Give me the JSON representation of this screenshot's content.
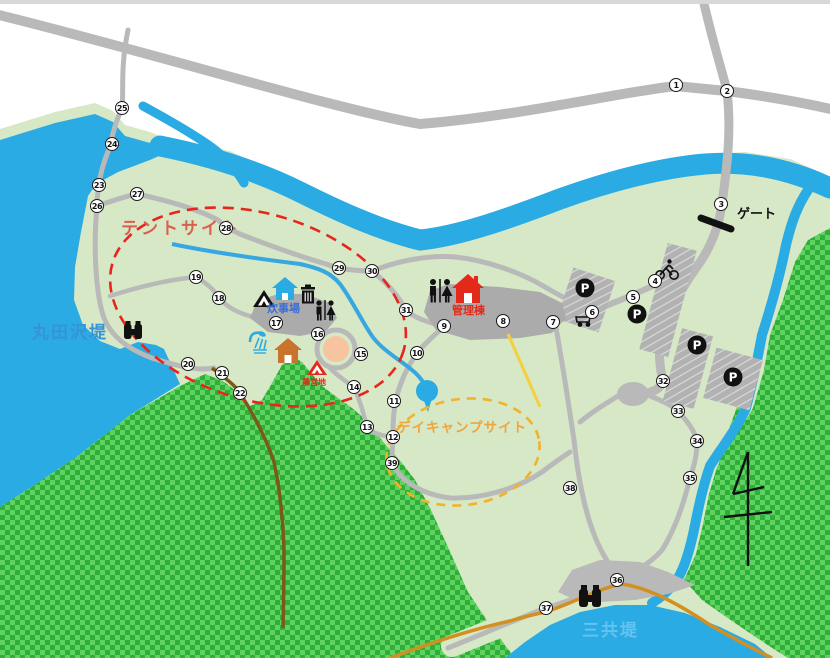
{
  "map": {
    "area_labels": {
      "lake_left": "丸田沢堤",
      "pond_bottom": "三共堤",
      "tent_site": "テントサイト",
      "day_camp_site": "デイキャンプサイト",
      "cooking_area": "炊事場",
      "admin_building": "管理棟",
      "gate": "ゲート",
      "camp_ground": "幕営地"
    },
    "icons": {
      "parking_letter": "P"
    },
    "colors": {
      "water": "#2aabe3",
      "park_green": "#d6e8c5",
      "forest_light": "#5fd35f",
      "forest_dark": "#2fae3a",
      "road_gray": "#b9b9b9",
      "building_gray": "#ababab",
      "tent_site_red": "#e8251d",
      "day_camp_yellow": "#f3b229",
      "trail_brown": "#7a5a17",
      "trail_orange": "#d29022",
      "fire_circle_pink": "#f6c5a0"
    },
    "markers": [
      {
        "n": "1",
        "x": 676,
        "y": 85
      },
      {
        "n": "2",
        "x": 727,
        "y": 91
      },
      {
        "n": "3",
        "x": 721,
        "y": 204
      },
      {
        "n": "4",
        "x": 655,
        "y": 281
      },
      {
        "n": "5",
        "x": 633,
        "y": 297
      },
      {
        "n": "6",
        "x": 592,
        "y": 312
      },
      {
        "n": "7",
        "x": 553,
        "y": 322
      },
      {
        "n": "8",
        "x": 503,
        "y": 321
      },
      {
        "n": "9",
        "x": 444,
        "y": 326
      },
      {
        "n": "10",
        "x": 417,
        "y": 353
      },
      {
        "n": "11",
        "x": 394,
        "y": 401
      },
      {
        "n": "12",
        "x": 393,
        "y": 437
      },
      {
        "n": "13",
        "x": 367,
        "y": 427
      },
      {
        "n": "14",
        "x": 354,
        "y": 387
      },
      {
        "n": "15",
        "x": 361,
        "y": 354
      },
      {
        "n": "16",
        "x": 318,
        "y": 334
      },
      {
        "n": "17",
        "x": 276,
        "y": 323
      },
      {
        "n": "18",
        "x": 219,
        "y": 298
      },
      {
        "n": "19",
        "x": 196,
        "y": 277
      },
      {
        "n": "20",
        "x": 188,
        "y": 364
      },
      {
        "n": "21",
        "x": 222,
        "y": 373
      },
      {
        "n": "22",
        "x": 240,
        "y": 393
      },
      {
        "n": "23",
        "x": 99,
        "y": 185
      },
      {
        "n": "24",
        "x": 112,
        "y": 144
      },
      {
        "n": "25",
        "x": 122,
        "y": 108
      },
      {
        "n": "26",
        "x": 97,
        "y": 206
      },
      {
        "n": "27",
        "x": 137,
        "y": 194
      },
      {
        "n": "28",
        "x": 226,
        "y": 228
      },
      {
        "n": "29",
        "x": 339,
        "y": 268
      },
      {
        "n": "30",
        "x": 372,
        "y": 271
      },
      {
        "n": "31",
        "x": 406,
        "y": 310
      },
      {
        "n": "32",
        "x": 663,
        "y": 381
      },
      {
        "n": "33",
        "x": 678,
        "y": 411
      },
      {
        "n": "34",
        "x": 697,
        "y": 441
      },
      {
        "n": "35",
        "x": 690,
        "y": 478
      },
      {
        "n": "36",
        "x": 617,
        "y": 580
      },
      {
        "n": "37",
        "x": 546,
        "y": 608
      },
      {
        "n": "38",
        "x": 570,
        "y": 488
      },
      {
        "n": "39",
        "x": 392,
        "y": 463
      }
    ]
  }
}
